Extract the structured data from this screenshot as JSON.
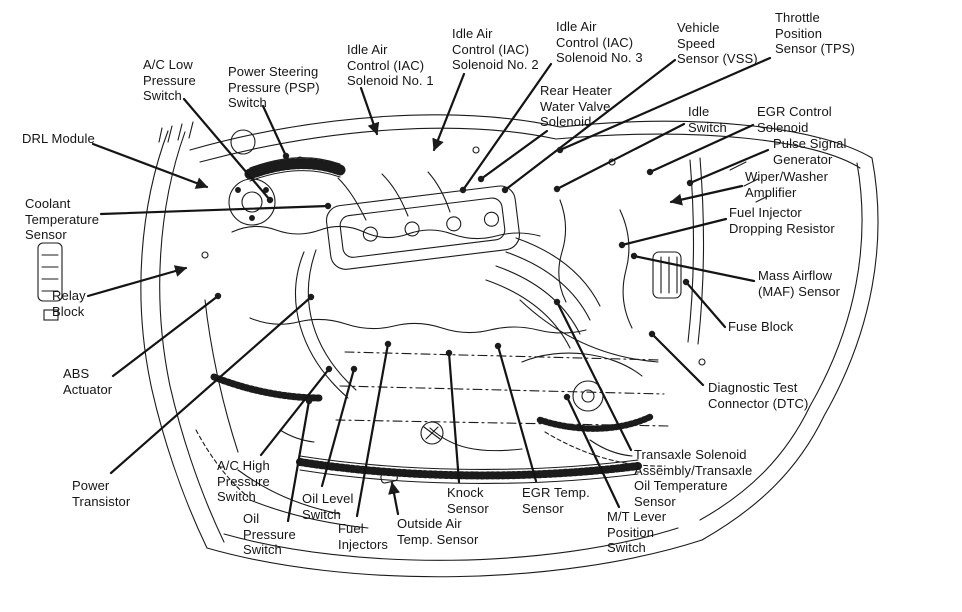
{
  "diagram": {
    "drawing": "engine-bay-line-art",
    "ink_color": "#1b1b1b",
    "background_color": "#ffffff",
    "labels": [
      {
        "id": "ac-low-pressure-switch",
        "text": "A/C Low\nPressure\nSwitch"
      },
      {
        "id": "power-steering-pressure-switch",
        "text": "Power Steering\nPressure (PSP)\nSwitch"
      },
      {
        "id": "iac-solenoid-1",
        "text": "Idle Air\nControl (IAC)\nSolenoid No. 1"
      },
      {
        "id": "iac-solenoid-2",
        "text": "Idle Air\nControl (IAC)\nSolenoid No. 2"
      },
      {
        "id": "iac-solenoid-3",
        "text": "Idle Air\nControl (IAC)\nSolenoid No. 3"
      },
      {
        "id": "vehicle-speed-sensor",
        "text": "Vehicle\nSpeed\nSensor (VSS)"
      },
      {
        "id": "throttle-position-sensor",
        "text": "Throttle\nPosition\nSensor (TPS)"
      },
      {
        "id": "rear-heater-water-valve-solenoid",
        "text": "Rear Heater\nWater Valve\nSolenoid"
      },
      {
        "id": "idle-switch",
        "text": "Idle\nSwitch"
      },
      {
        "id": "egr-control-solenoid",
        "text": "EGR Control\nSolenoid"
      },
      {
        "id": "pulse-signal-generator",
        "text": "Pulse Signal\nGenerator"
      },
      {
        "id": "wiper-washer-amplifier",
        "text": "Wiper/Washer\nAmplifier"
      },
      {
        "id": "fuel-injector-dropping-resistor",
        "text": "Fuel Injector\nDropping Resistor"
      },
      {
        "id": "drl-module",
        "text": "DRL Module"
      },
      {
        "id": "coolant-temperature-sensor",
        "text": "Coolant\nTemperature\nSensor"
      },
      {
        "id": "relay-block",
        "text": "Relay\nBlock"
      },
      {
        "id": "abs-actuator",
        "text": "ABS\nActuator"
      },
      {
        "id": "mass-airflow-sensor",
        "text": "Mass Airflow\n(MAF) Sensor"
      },
      {
        "id": "fuse-block",
        "text": "Fuse Block"
      },
      {
        "id": "diagnostic-test-connector",
        "text": "Diagnostic Test\nConnector (DTC)"
      },
      {
        "id": "transaxle-solenoid-assembly",
        "text": "Transaxle Solenoid\nAssembly/Transaxle\nOil Temperature\nSensor"
      },
      {
        "id": "mt-lever-position-switch",
        "text": "M/T Lever\nPosition\nSwitch"
      },
      {
        "id": "power-transistor",
        "text": "Power\nTransistor"
      },
      {
        "id": "ac-high-pressure-switch",
        "text": "A/C High\nPressure\nSwitch"
      },
      {
        "id": "oil-pressure-switch",
        "text": "Oil\nPressure\nSwitch"
      },
      {
        "id": "oil-level-switch",
        "text": "Oil Level\nSwitch"
      },
      {
        "id": "fuel-injectors",
        "text": "Fuel\nInjectors"
      },
      {
        "id": "outside-air-temp-sensor",
        "text": "Outside Air\nTemp. Sensor"
      },
      {
        "id": "knock-sensor",
        "text": "Knock\nSensor"
      },
      {
        "id": "egr-temp-sensor",
        "text": "EGR Temp.\nSensor"
      }
    ]
  }
}
